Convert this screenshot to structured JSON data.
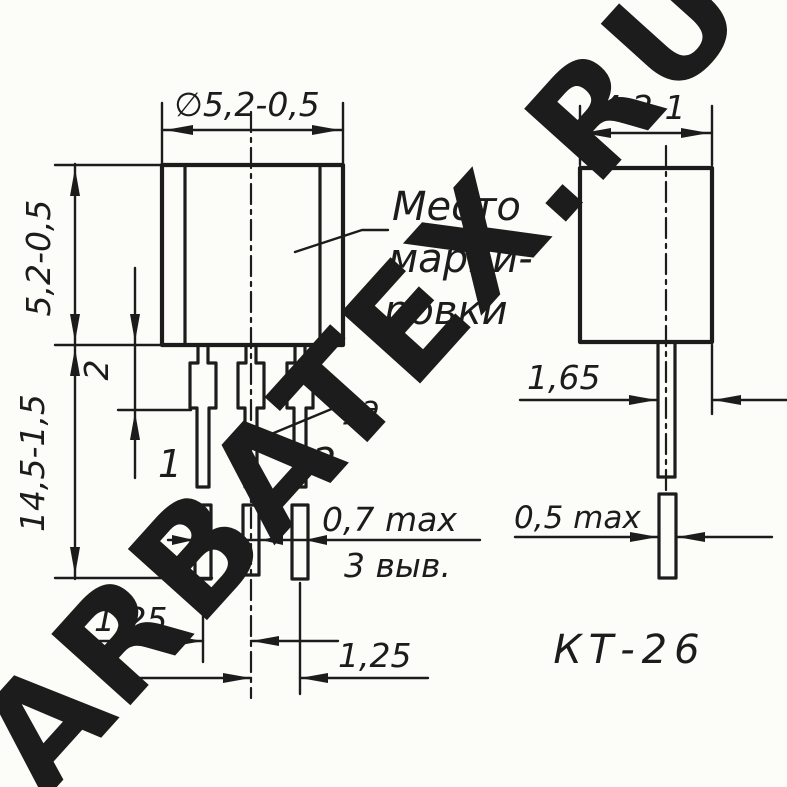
{
  "watermark": {
    "text": "ARBATEX.RU",
    "color": "#f6a8a8"
  },
  "drawing": {
    "ink_color": "#1c1c1c",
    "paper_color": "#fcfcf9",
    "package_name": "КТ-26",
    "front_view": {
      "dim_diameter": "∅5,2-0,5",
      "dim_body_height": "5,2-0,5",
      "dim_total_height": "14,5-1,5",
      "dim_lead_shoulder": "2",
      "marking_line1": "Место",
      "marking_line2": "марки-",
      "marking_line3": "ровки",
      "gate_lead_label": "уэ",
      "lead1_label": "1",
      "lead2_label": "2",
      "dim_lead_thickness": "0,7 max",
      "leads_count_note": "3 выв.",
      "dim_pitch_12": "1,25",
      "dim_pitch_23": "1,25"
    },
    "side_view": {
      "dim_depth": "4,2-1",
      "dim_lead_offset": "1,65",
      "dim_lead_width": "0,5 max"
    }
  }
}
